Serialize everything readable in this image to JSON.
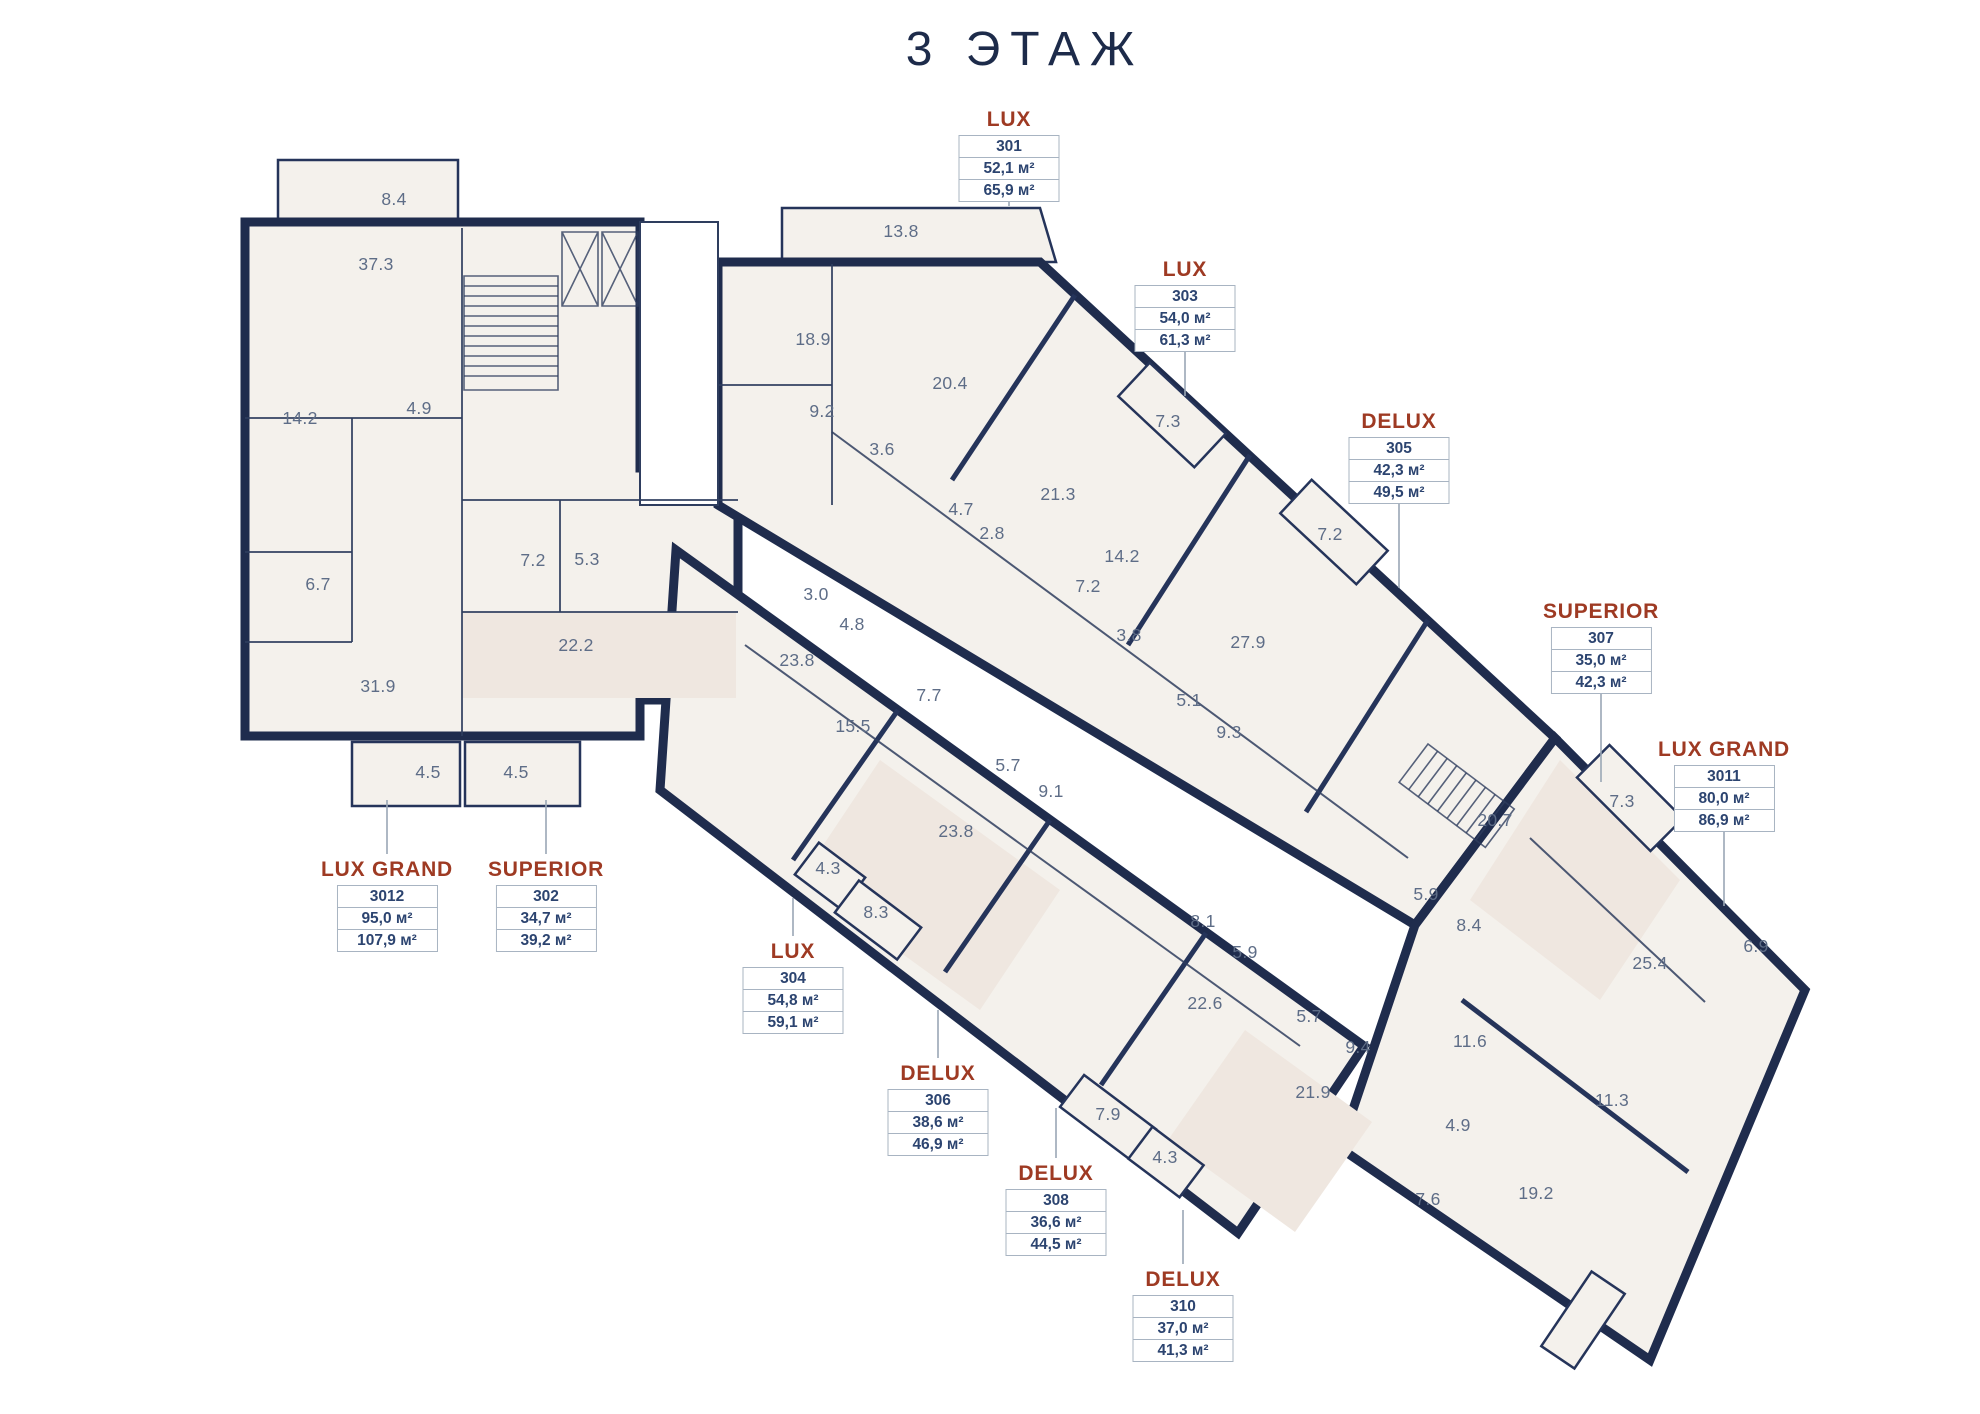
{
  "title": "3 ЭТАЖ",
  "colors": {
    "wall": "#1f2c4d",
    "floor": "#f4f1ec",
    "floor_tint": "#efe7e0",
    "room_text": "#5e6d87",
    "unit_type_text": "#9e3a23",
    "unit_value_text": "#2c4470",
    "leader": "#9aa7b6",
    "box_border": "#a8b4c2",
    "title_text": "#1d2b4a"
  },
  "units": [
    {
      "type": "LUX",
      "number": "301",
      "area_living": "52,1 м²",
      "area_total": "65,9 м²",
      "x": 1009,
      "y": 108,
      "leader": [
        1009,
        190,
        1009,
        206
      ]
    },
    {
      "type": "LUX",
      "number": "303",
      "area_living": "54,0 м²",
      "area_total": "61,3 м²",
      "x": 1185,
      "y": 258,
      "leader": [
        1185,
        342,
        1185,
        396
      ]
    },
    {
      "type": "DELUX",
      "number": "305",
      "area_living": "42,3 м²",
      "area_total": "49,5 м²",
      "x": 1399,
      "y": 410,
      "leader": [
        1399,
        494,
        1399,
        588
      ]
    },
    {
      "type": "SUPERIOR",
      "number": "307",
      "area_living": "35,0 м²",
      "area_total": "42,3 м²",
      "x": 1601,
      "y": 600,
      "leader": [
        1601,
        684,
        1601,
        782
      ]
    },
    {
      "type": "LUX GRAND",
      "number": "3011",
      "area_living": "80,0 м²",
      "area_total": "86,9 м²",
      "x": 1724,
      "y": 738,
      "leader": [
        1724,
        822,
        1724,
        906
      ]
    },
    {
      "type": "LUX GRAND",
      "number": "3012",
      "area_living": "95,0 м²",
      "area_total": "107,9 м²",
      "x": 387,
      "y": 858,
      "leader": [
        387,
        800,
        387,
        854
      ]
    },
    {
      "type": "SUPERIOR",
      "number": "302",
      "area_living": "34,7 м²",
      "area_total": "39,2 м²",
      "x": 546,
      "y": 858,
      "leader": [
        546,
        800,
        546,
        854
      ]
    },
    {
      "type": "LUX",
      "number": "304",
      "area_living": "54,8 м²",
      "area_total": "59,1 м²",
      "x": 793,
      "y": 940,
      "leader": [
        793,
        898,
        793,
        936
      ]
    },
    {
      "type": "DELUX",
      "number": "306",
      "area_living": "38,6 м²",
      "area_total": "46,9 м²",
      "x": 938,
      "y": 1062,
      "leader": [
        938,
        1010,
        938,
        1058
      ]
    },
    {
      "type": "DELUX",
      "number": "308",
      "area_living": "36,6 м²",
      "area_total": "44,5 м²",
      "x": 1056,
      "y": 1162,
      "leader": [
        1056,
        1108,
        1056,
        1158
      ]
    },
    {
      "type": "DELUX",
      "number": "310",
      "area_living": "37,0 м²",
      "area_total": "41,3 м²",
      "x": 1183,
      "y": 1268,
      "leader": [
        1183,
        1210,
        1183,
        1264
      ]
    }
  ],
  "rooms": [
    {
      "v": "8.4",
      "x": 394,
      "y": 205
    },
    {
      "v": "37.3",
      "x": 376,
      "y": 270
    },
    {
      "v": "14.2",
      "x": 300,
      "y": 424
    },
    {
      "v": "4.9",
      "x": 419,
      "y": 414
    },
    {
      "v": "6.7",
      "x": 318,
      "y": 590
    },
    {
      "v": "31.9",
      "x": 378,
      "y": 692
    },
    {
      "v": "7.2",
      "x": 533,
      "y": 566
    },
    {
      "v": "5.3",
      "x": 587,
      "y": 565
    },
    {
      "v": "22.2",
      "x": 576,
      "y": 651
    },
    {
      "v": "4.5",
      "x": 428,
      "y": 778
    },
    {
      "v": "4.5",
      "x": 516,
      "y": 778
    },
    {
      "v": "13.8",
      "x": 901,
      "y": 237
    },
    {
      "v": "18.9",
      "x": 813,
      "y": 345
    },
    {
      "v": "9.2",
      "x": 822,
      "y": 417
    },
    {
      "v": "20.4",
      "x": 950,
      "y": 389
    },
    {
      "v": "3.6",
      "x": 882,
      "y": 455
    },
    {
      "v": "4.7",
      "x": 961,
      "y": 515
    },
    {
      "v": "2.8",
      "x": 992,
      "y": 539
    },
    {
      "v": "21.3",
      "x": 1058,
      "y": 500
    },
    {
      "v": "14.2",
      "x": 1122,
      "y": 562
    },
    {
      "v": "7.2",
      "x": 1088,
      "y": 592
    },
    {
      "v": "3.8",
      "x": 1129,
      "y": 641
    },
    {
      "v": "7.3",
      "x": 1168,
      "y": 427
    },
    {
      "v": "7.2",
      "x": 1330,
      "y": 540
    },
    {
      "v": "27.9",
      "x": 1248,
      "y": 648
    },
    {
      "v": "5.1",
      "x": 1189,
      "y": 706
    },
    {
      "v": "9.3",
      "x": 1229,
      "y": 738
    },
    {
      "v": "3.0",
      "x": 816,
      "y": 600
    },
    {
      "v": "4.8",
      "x": 852,
      "y": 630
    },
    {
      "v": "23.8",
      "x": 797,
      "y": 666
    },
    {
      "v": "7.7",
      "x": 929,
      "y": 701
    },
    {
      "v": "15.5",
      "x": 853,
      "y": 732
    },
    {
      "v": "5.7",
      "x": 1008,
      "y": 771
    },
    {
      "v": "9.1",
      "x": 1051,
      "y": 797
    },
    {
      "v": "23.8",
      "x": 956,
      "y": 837
    },
    {
      "v": "4.3",
      "x": 828,
      "y": 874
    },
    {
      "v": "8.3",
      "x": 876,
      "y": 918
    },
    {
      "v": "8.1",
      "x": 1203,
      "y": 927
    },
    {
      "v": "5.9",
      "x": 1245,
      "y": 958
    },
    {
      "v": "22.6",
      "x": 1205,
      "y": 1009
    },
    {
      "v": "5.7",
      "x": 1309,
      "y": 1022
    },
    {
      "v": "9.4",
      "x": 1358,
      "y": 1053
    },
    {
      "v": "21.9",
      "x": 1313,
      "y": 1098
    },
    {
      "v": "7.9",
      "x": 1108,
      "y": 1120
    },
    {
      "v": "4.3",
      "x": 1165,
      "y": 1163
    },
    {
      "v": "5.9",
      "x": 1426,
      "y": 900
    },
    {
      "v": "8.4",
      "x": 1469,
      "y": 931
    },
    {
      "v": "20.7",
      "x": 1495,
      "y": 826
    },
    {
      "v": "7.3",
      "x": 1622,
      "y": 807
    },
    {
      "v": "11.6",
      "x": 1470,
      "y": 1047
    },
    {
      "v": "4.9",
      "x": 1458,
      "y": 1131
    },
    {
      "v": "25.4",
      "x": 1650,
      "y": 969
    },
    {
      "v": "6.9",
      "x": 1756,
      "y": 952
    },
    {
      "v": "11.3",
      "x": 1612,
      "y": 1106
    },
    {
      "v": "19.2",
      "x": 1536,
      "y": 1199
    },
    {
      "v": "7.6",
      "x": 1428,
      "y": 1205
    }
  ]
}
